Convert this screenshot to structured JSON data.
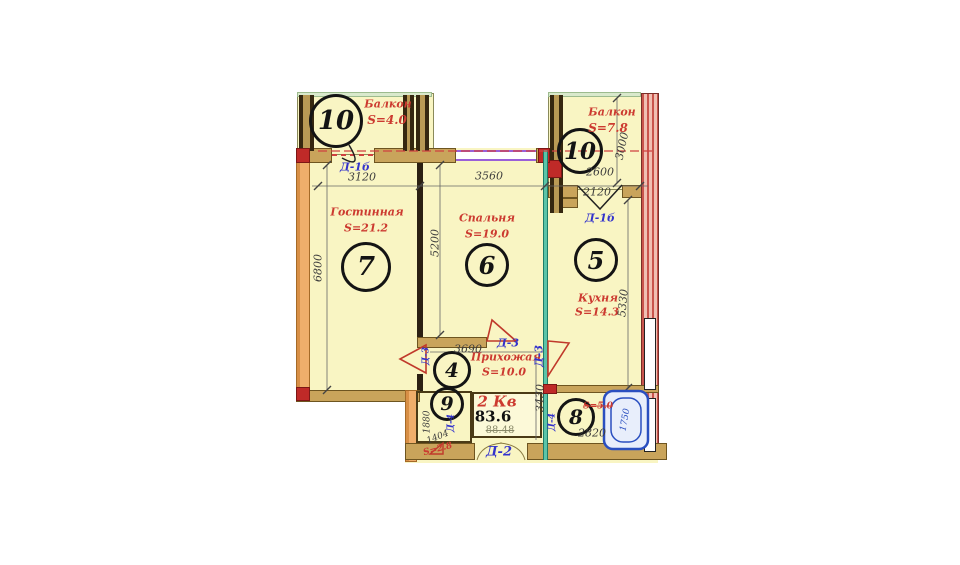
{
  "apartment": {
    "label": "2 Кв",
    "total_area": "83.6",
    "old_area": "88.48"
  },
  "rooms": {
    "balcony_left": {
      "number": "10",
      "name": "Балкон",
      "area": "S=4.0"
    },
    "balcony_right": {
      "number": "10",
      "name": "Балкон",
      "area": "S=7.8"
    },
    "living": {
      "number": "7",
      "name": "Гостинная",
      "area": "S=21.2"
    },
    "bedroom": {
      "number": "6",
      "name": "Спальня",
      "area": "S=19.0"
    },
    "kitchen": {
      "number": "5",
      "name": "Кухня",
      "area": "S=14.3"
    },
    "hallway": {
      "number": "4",
      "name": "Прихожая",
      "area": "S=10.0"
    },
    "wc": {
      "number": "9",
      "area": "S=2.8"
    },
    "bathroom": {
      "number": "8",
      "area": "S=5.0"
    }
  },
  "doors": {
    "balcony_left_door": "Д-1б",
    "balcony_right_door": "Д-1б",
    "entry_door": "Д-2",
    "hall_door_top": "Д-3",
    "hall_door_left": "Д-3",
    "hall_door_right": "Д-3",
    "wc_door": "Д-4",
    "bath_door": "Д-4"
  },
  "dimensions": {
    "balcony_left_width": "3120",
    "bedroom_width": "3560",
    "balcony_right_width": "2600",
    "balcony_right_door_width": "2120",
    "balcony_right_depth": "3000",
    "living_depth": "6800",
    "living_width": "5200",
    "kitchen_depth": "5330",
    "hallway_width": "3690",
    "hallway_depth": "3430",
    "wc_depth": "1880",
    "wc_width": "1404",
    "bathroom_width": "2820",
    "bathtub_length": "1750"
  },
  "colors": {
    "room_fill": "#f9f5c3",
    "wall_tan": "#c9a45b",
    "wall_red_accent": "#bf2a28",
    "partition_teal": "#5bc4a8",
    "label_red": "#cc3a30",
    "label_blue": "#3333cc",
    "window_purple": "#9a5fd8",
    "bathtub_blue": "#2a4fc0"
  }
}
